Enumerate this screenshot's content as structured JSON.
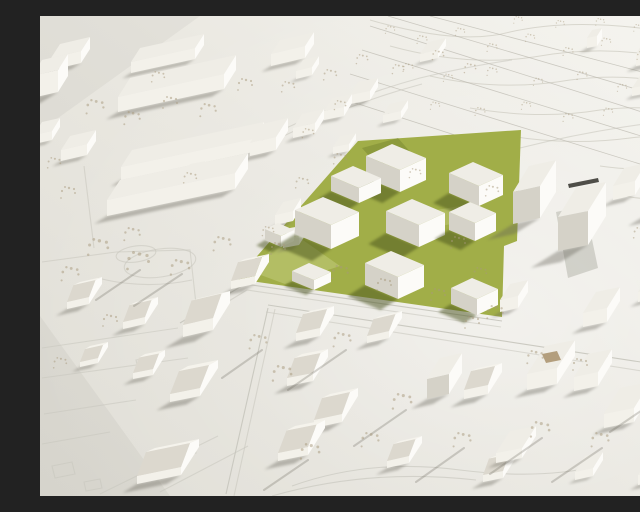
{
  "meta": {
    "image_type": "photograph",
    "subject": "architectural scale model of an urban district masterplan",
    "view": "oblique aerial view of a physical model",
    "lighting": "low sun from the upper right casting long branch shadows toward the lower left",
    "description": "Photograph of a white architectural scale model seen from above. A chartreuse-green development site in the center carries ten new flat-roofed white building volumes and small wire trees. The surrounding all-white context shows large perimeter blocks and slabs at the upper left, a terraced hillside with contour lines and rows of orchard trees at the upper right, taller blocks to the right of the site, pitched-roof houses along engraved streets below, and a dark expansion joint running along the right edge of the green site."
  },
  "site": {
    "ground_color_name": "chartreuse green",
    "new_building_volume_count": 10,
    "building_style": "flat-roofed rectangular volumes",
    "tree_style": "bare wire model trees",
    "edge_feature": "dark model joint line on the east edge"
  },
  "context": {
    "upper_left": "long white slabs and a large courtyard perimeter block with park and circular paths",
    "top_right": "terraced hillside with engraved contour lines and rows of small trees",
    "right": "tall white blocks with sunlit east faces",
    "bottom": "gabled and hipped roof houses, engraved streets, bright open plaza"
  },
  "colors": {
    "bg_dark": "#e0ddd5",
    "bg_light": "#f4f3ee",
    "b_top": "#efede6",
    "b_lit": "#fcfbf8",
    "b_lit2": "#f3f1ea",
    "b_shade": "#d5d2c8",
    "roof_lit": "#f5f3ec",
    "roof_shade": "#dcd8ce",
    "site_green": "#a1ae48",
    "site_green_light": "#c3cc7c",
    "site_green_dark": "#78862f",
    "shadow": "rgba(99,97,87,0.38)",
    "shadow_green": "rgba(70,79,26,0.5)",
    "tree": "#a8997c",
    "tree_shadow": "rgba(104,99,88,0.33)",
    "contour": "#d8d6cd",
    "road": "#c7c5bc",
    "terrace": "#bdbbb2",
    "joint": "#3c3b35",
    "court_interior": "#b39e7d"
  }
}
